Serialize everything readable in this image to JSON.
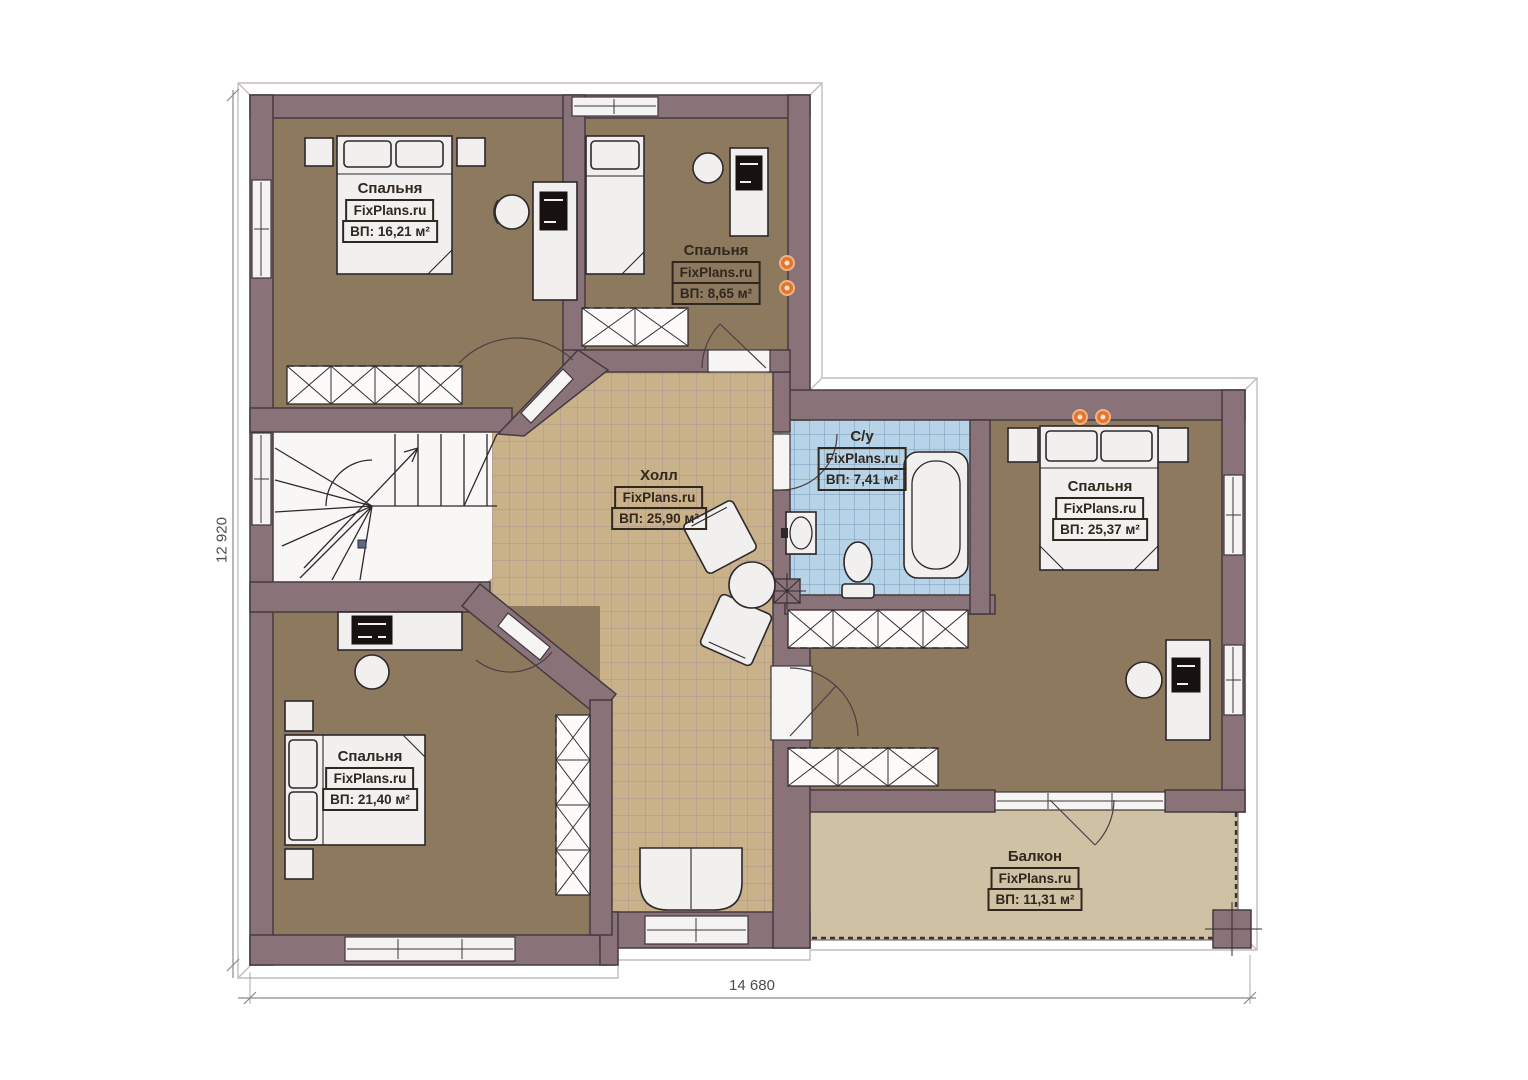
{
  "plan": {
    "type": "second-floor-plan",
    "brand": "FixPlans.ru",
    "dimension_bottom": "14 680",
    "dimension_left": "12 920"
  },
  "rooms": {
    "bedroom_top_left": {
      "name": "Спальня",
      "brand": "FixPlans.ru",
      "area": "ВП: 16,21 м²"
    },
    "bedroom_top_middle": {
      "name": "Спальня",
      "brand": "FixPlans.ru",
      "area": "ВП: 8,65 м²"
    },
    "hall": {
      "name": "Холл",
      "brand": "FixPlans.ru",
      "area": "ВП: 25,90 м²"
    },
    "bathroom": {
      "name": "С/у",
      "brand": "FixPlans.ru",
      "area": "ВП: 7,41 м²"
    },
    "bedroom_right": {
      "name": "Спальня",
      "brand": "FixPlans.ru",
      "area": "ВП: 25,37 м²"
    },
    "bedroom_bottom_left": {
      "name": "Спальня",
      "brand": "FixPlans.ru",
      "area": "ВП: 21,40 м²"
    },
    "balcony": {
      "name": "Балкон",
      "brand": "FixPlans.ru",
      "area": "ВП: 11,31 м²"
    }
  },
  "colors": {
    "wall": "#8a7279",
    "bedroom_floor": "#8d7a5e",
    "hall_floor": "#c9b189",
    "bathroom_floor": "#b7d3e7",
    "balcony_floor": "#cfc1a3",
    "stairwell_floor": "#f8f7f5",
    "light_dot": "#e2762e"
  }
}
